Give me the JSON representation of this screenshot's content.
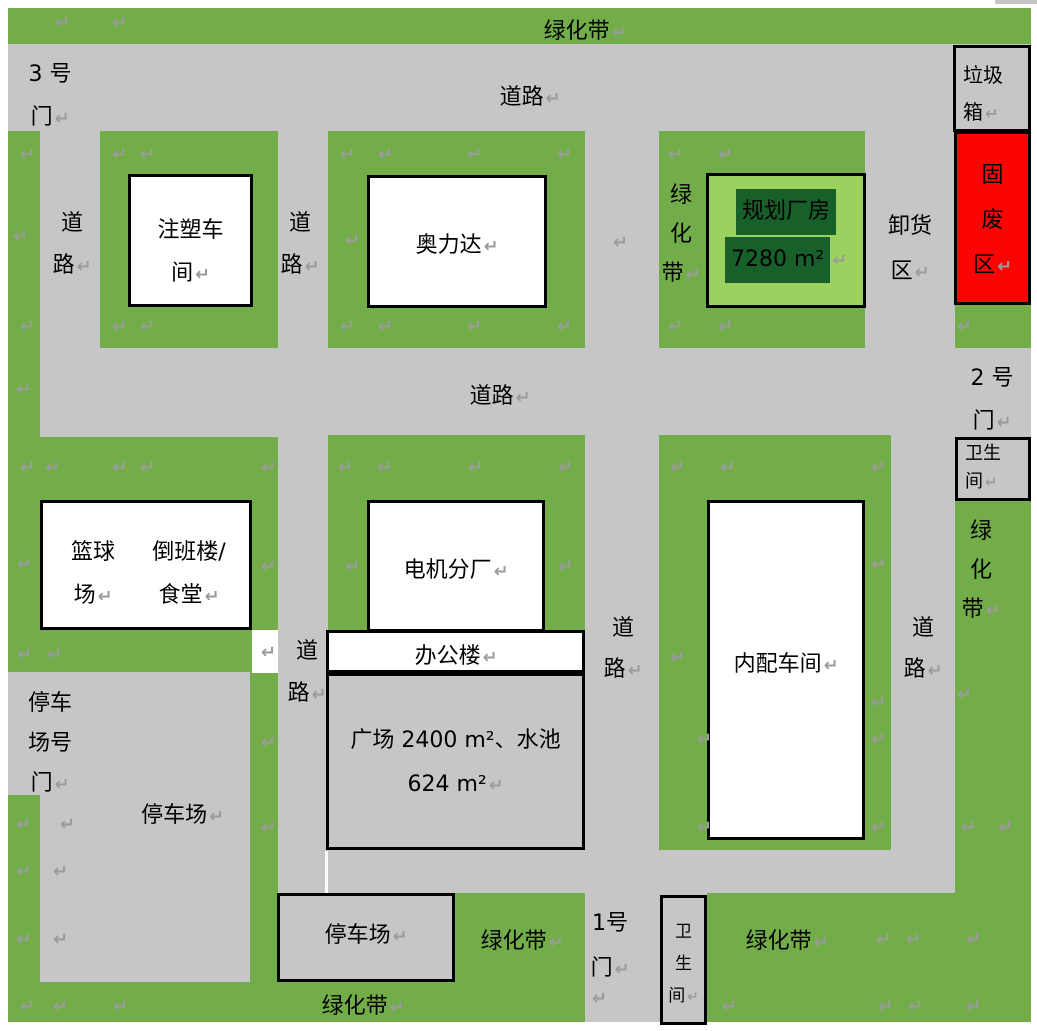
{
  "page": {
    "width": 1037,
    "height": 1031,
    "background": "#ffffff",
    "description": "factory site plan"
  },
  "colors": {
    "green": "#72AD4A",
    "light_green": "#9BD15E",
    "dark_green": "#17602A",
    "road_gray": "#C6C6C6",
    "red": "#FC0404",
    "white": "#FFFFFF",
    "mark_gray": "#9B9B9B",
    "border_black": "#000000"
  },
  "pilcrow_char": "↵",
  "regions": [
    {
      "n": "page-backdrop",
      "x": 8,
      "y": 8,
      "w": 1023,
      "h": 1014,
      "f": "road_gray"
    },
    {
      "n": "greenbelt-top-strip",
      "x": 8,
      "y": 8,
      "w": 1023,
      "h": 36,
      "f": "green"
    },
    {
      "n": "greenbelt-left-upper",
      "x": 8,
      "y": 131,
      "w": 32,
      "h": 541,
      "f": "green"
    },
    {
      "n": "greenbelt-left-lower",
      "x": 8,
      "y": 795,
      "w": 32,
      "h": 227,
      "f": "green"
    },
    {
      "n": "green-block-injection",
      "x": 100,
      "y": 131,
      "w": 178,
      "h": 217,
      "f": "green"
    },
    {
      "n": "green-block-aolida",
      "x": 328,
      "y": 131,
      "w": 257,
      "h": 217,
      "f": "green"
    },
    {
      "n": "green-block-planned",
      "x": 659,
      "y": 131,
      "w": 206,
      "h": 217,
      "f": "green"
    },
    {
      "n": "green-right-under-waste",
      "x": 955,
      "y": 305,
      "w": 76,
      "h": 43,
      "f": "green"
    },
    {
      "n": "greenbelt-right-column",
      "x": 955,
      "y": 500,
      "w": 76,
      "h": 522,
      "f": "green"
    },
    {
      "n": "green-block-basketball",
      "x": 8,
      "y": 437,
      "w": 270,
      "h": 235,
      "f": "green"
    },
    {
      "n": "green-strip-parking",
      "x": 250,
      "y": 672,
      "w": 28,
      "h": 310,
      "f": "green"
    },
    {
      "n": "green-block-motor",
      "x": 328,
      "y": 435,
      "w": 257,
      "h": 195,
      "f": "green"
    },
    {
      "n": "green-block-internal",
      "x": 659,
      "y": 435,
      "w": 232,
      "h": 415,
      "f": "green"
    },
    {
      "n": "greenbelt-bottom-strip",
      "x": 8,
      "y": 982,
      "w": 577,
      "h": 40,
      "f": "green"
    },
    {
      "n": "green-mid-bottom",
      "x": 455,
      "y": 893,
      "w": 130,
      "h": 89,
      "f": "green"
    },
    {
      "n": "green-bottom-right",
      "x": 707,
      "y": 893,
      "w": 324,
      "h": 129,
      "f": "green"
    },
    {
      "n": "white-notch",
      "x": 252,
      "y": 630,
      "w": 26,
      "h": 43,
      "f": "white"
    },
    {
      "n": "white-gap-line",
      "x": 325,
      "y": 851,
      "w": 3,
      "h": 42,
      "f": "white"
    },
    {
      "n": "window-artifact",
      "x": 995,
      "y": 0,
      "w": 42,
      "h": 4,
      "f": "road_gray"
    },
    {
      "n": "trash-bin-box",
      "x": 953,
      "y": 45,
      "w": 78,
      "h": 87,
      "f": "road_gray",
      "b": 1
    },
    {
      "n": "solid-waste-box",
      "x": 954,
      "y": 131,
      "w": 77,
      "h": 174,
      "f": "red",
      "b": 1
    },
    {
      "n": "restroom-right-box",
      "x": 955,
      "y": 437,
      "w": 76,
      "h": 64,
      "f": "road_gray",
      "b": 1
    },
    {
      "n": "injection-workshop-box",
      "x": 128,
      "y": 174,
      "w": 125,
      "h": 133,
      "f": "white",
      "b": 1
    },
    {
      "n": "aolida-box",
      "x": 367,
      "y": 175,
      "w": 180,
      "h": 133,
      "f": "white",
      "b": 1
    },
    {
      "n": "planned-building-box",
      "x": 706,
      "y": 173,
      "w": 160,
      "h": 135,
      "f": "light_green",
      "b": 1
    },
    {
      "n": "basketball-box",
      "x": 40,
      "y": 500,
      "w": 212,
      "h": 130,
      "f": "white",
      "b": 1
    },
    {
      "n": "motor-plant-box",
      "x": 367,
      "y": 500,
      "w": 178,
      "h": 132,
      "f": "white",
      "b": 1
    },
    {
      "n": "office-building-box",
      "x": 326,
      "y": 630,
      "w": 259,
      "h": 43,
      "f": "white",
      "b": 1
    },
    {
      "n": "plaza-box",
      "x": 326,
      "y": 673,
      "w": 259,
      "h": 177,
      "f": "road_gray",
      "b": 1
    },
    {
      "n": "internal-workshop-box",
      "x": 707,
      "y": 500,
      "w": 158,
      "h": 340,
      "f": "white",
      "b": 1
    },
    {
      "n": "parking-lot-box",
      "x": 277,
      "y": 893,
      "w": 178,
      "h": 89,
      "f": "road_gray",
      "b": 1
    },
    {
      "n": "restroom-bottom-box",
      "x": 660,
      "y": 895,
      "w": 47,
      "h": 130,
      "f": "road_gray",
      "b": 1
    }
  ],
  "labels": [
    {
      "n": "greenbelt-top-label",
      "t": "绿化带",
      "x": 505,
      "y": 13,
      "w": 160,
      "pc": 1
    },
    {
      "n": "gate-3-label",
      "t": "3 号\n门",
      "x": 14,
      "y": 53,
      "w": 72,
      "lh": 43,
      "pc": 1
    },
    {
      "n": "road-top-label",
      "t": "道路",
      "x": 450,
      "y": 79,
      "w": 160,
      "pc": 1
    },
    {
      "n": "road-row1-left-label",
      "t": "道\n路",
      "x": 44,
      "y": 203,
      "w": 56,
      "lh": 42,
      "pc": 1
    },
    {
      "n": "road-row1-mid-label",
      "t": "道\n路",
      "x": 272,
      "y": 203,
      "w": 56,
      "lh": 42,
      "pc": 1
    },
    {
      "n": "greenbelt-block-c-label",
      "t": "绿\n化\n带",
      "x": 660,
      "y": 176,
      "w": 42,
      "lh": 39,
      "pc": 1
    },
    {
      "n": "unloading-area-label",
      "t": "卸货\n区",
      "x": 877,
      "y": 204,
      "w": 66,
      "lh": 45,
      "pc": 1
    },
    {
      "n": "trash-bin-label",
      "t": "垃圾\n箱",
      "x": 963,
      "y": 57,
      "w": 64,
      "lh": 37,
      "s": 20,
      "a": "left",
      "pc": 1
    },
    {
      "n": "solid-waste-label",
      "t": "固\n废\n区",
      "x": 954,
      "y": 153,
      "w": 77,
      "lh": 45,
      "pc": 1
    },
    {
      "n": "gate-2-label",
      "t": "2 号\n门",
      "x": 955,
      "y": 357,
      "w": 74,
      "lh": 43,
      "pc": 1
    },
    {
      "n": "restroom-right-label",
      "t": "卫生\n间",
      "x": 965,
      "y": 440,
      "w": 62,
      "lh": 28,
      "s": 18,
      "a": "left",
      "pc": 1
    },
    {
      "n": "road-middle-label",
      "t": "道路",
      "x": 420,
      "y": 378,
      "w": 160,
      "pc": 1
    },
    {
      "n": "greenbelt-right-label",
      "t": "绿\n化\n带",
      "x": 953,
      "y": 512,
      "w": 56,
      "lh": 39,
      "pc": 1
    },
    {
      "n": "road-right-label",
      "t": "道\n路",
      "x": 895,
      "y": 608,
      "w": 56,
      "lh": 41,
      "pc": 1
    },
    {
      "n": "road-mid-column-label",
      "t": "道\n路",
      "x": 595,
      "y": 608,
      "w": 56,
      "lh": 41,
      "pc": 1
    },
    {
      "n": "road-left-lower-label",
      "t": "道\n路",
      "x": 281,
      "y": 631,
      "w": 52,
      "lh": 42,
      "pc": 1
    },
    {
      "n": "basketball-court-label",
      "t": "篮球\n场",
      "x": 46,
      "y": 531,
      "w": 94,
      "lh": 43,
      "pc": 1
    },
    {
      "n": "shift-building-label",
      "t": "倒班楼/\n食堂",
      "x": 134,
      "y": 531,
      "w": 110,
      "lh": 43,
      "pc": 1
    },
    {
      "n": "motor-plant-label",
      "t": "电机分厂",
      "x": 377,
      "y": 552,
      "w": 158,
      "pc": 1
    },
    {
      "n": "office-building-label",
      "t": "办公楼",
      "x": 391,
      "y": 638,
      "w": 130,
      "pc": 1
    },
    {
      "n": "plaza-label",
      "t": "广场 2400 m²、水池\n624 m²",
      "x": 331,
      "y": 719,
      "w": 249,
      "lh": 44,
      "pc": 1
    },
    {
      "n": "internal-workshop-label",
      "t": "内配车间",
      "x": 716,
      "y": 646,
      "w": 140,
      "pc": 1
    },
    {
      "n": "aolida-label",
      "t": "奥力达",
      "x": 387,
      "y": 227,
      "w": 140,
      "pc": 1
    },
    {
      "n": "injection-workshop-label",
      "t": "注塑车\n间",
      "x": 131,
      "y": 209,
      "w": 119,
      "lh": 43,
      "pc": 1
    },
    {
      "n": "planned-building-label",
      "t": "规划厂房\n7280 m²",
      "x": 711,
      "y": 188,
      "w": 150,
      "lh": 42,
      "hl": 1,
      "pc": 1
    },
    {
      "n": "parking-gate-label",
      "t": "停车\n场号\n门",
      "x": 14,
      "y": 684,
      "w": 72,
      "lh": 40,
      "pc": 1
    },
    {
      "n": "parking-main-label",
      "t": "停车场",
      "x": 120,
      "y": 797,
      "w": 125,
      "pc": 1
    },
    {
      "n": "parking-box-label",
      "t": "停车场",
      "x": 300,
      "y": 917,
      "w": 132,
      "pc": 1
    },
    {
      "n": "greenbelt-mid-bottom-label",
      "t": "绿化带",
      "x": 462,
      "y": 923,
      "w": 120,
      "pc": 1
    },
    {
      "n": "gate-1-label",
      "t": "1号\n门",
      "x": 576,
      "y": 901,
      "w": 68,
      "lh": 45,
      "pc": 1
    },
    {
      "n": "restroom-bottom-label",
      "t": "卫\n生\n间",
      "x": 660,
      "y": 916,
      "w": 47,
      "lh": 32,
      "s": 17,
      "pc": 1
    },
    {
      "n": "greenbelt-bottom-right-label",
      "t": "绿化带",
      "x": 726,
      "y": 923,
      "w": 122,
      "pc": 1
    },
    {
      "n": "greenbelt-bottom-label",
      "t": "绿化带",
      "x": 302,
      "y": 988,
      "w": 122,
      "pc": 1
    }
  ],
  "pilcrows": [
    [
      55,
      14
    ],
    [
      112,
      14
    ],
    [
      20,
      146
    ],
    [
      112,
      146
    ],
    [
      140,
      146
    ],
    [
      340,
      146
    ],
    [
      378,
      146
    ],
    [
      467,
      146
    ],
    [
      557,
      146
    ],
    [
      668,
      146
    ],
    [
      718,
      146
    ],
    [
      957,
      318
    ],
    [
      13,
      228
    ],
    [
      345,
      232
    ],
    [
      613,
      234
    ],
    [
      20,
      318
    ],
    [
      112,
      318
    ],
    [
      140,
      318
    ],
    [
      340,
      318
    ],
    [
      378,
      318
    ],
    [
      467,
      318
    ],
    [
      557,
      318
    ],
    [
      668,
      318
    ],
    [
      718,
      318
    ],
    [
      16,
      381
    ],
    [
      20,
      459
    ],
    [
      45,
      459
    ],
    [
      112,
      459
    ],
    [
      140,
      459
    ],
    [
      261,
      459
    ],
    [
      338,
      459
    ],
    [
      377,
      459
    ],
    [
      468,
      459
    ],
    [
      558,
      459
    ],
    [
      670,
      459
    ],
    [
      720,
      459
    ],
    [
      871,
      459
    ],
    [
      17,
      556
    ],
    [
      261,
      558
    ],
    [
      345,
      558
    ],
    [
      558,
      558
    ],
    [
      871,
      556
    ],
    [
      17,
      646
    ],
    [
      47,
      646
    ],
    [
      261,
      644
    ],
    [
      670,
      649
    ],
    [
      871,
      694
    ],
    [
      957,
      686
    ],
    [
      261,
      734
    ],
    [
      261,
      819
    ],
    [
      16,
      816
    ],
    [
      60,
      816
    ],
    [
      16,
      863
    ],
    [
      53,
      863
    ],
    [
      697,
      731
    ],
    [
      871,
      731
    ],
    [
      697,
      819
    ],
    [
      871,
      819
    ],
    [
      961,
      819
    ],
    [
      998,
      819
    ],
    [
      16,
      931
    ],
    [
      53,
      931
    ],
    [
      876,
      931
    ],
    [
      906,
      931
    ],
    [
      966,
      931
    ],
    [
      20,
      998
    ],
    [
      53,
      998
    ],
    [
      113,
      998
    ],
    [
      592,
      990
    ],
    [
      722,
      998
    ],
    [
      878,
      998
    ],
    [
      908,
      998
    ],
    [
      966,
      998
    ]
  ]
}
